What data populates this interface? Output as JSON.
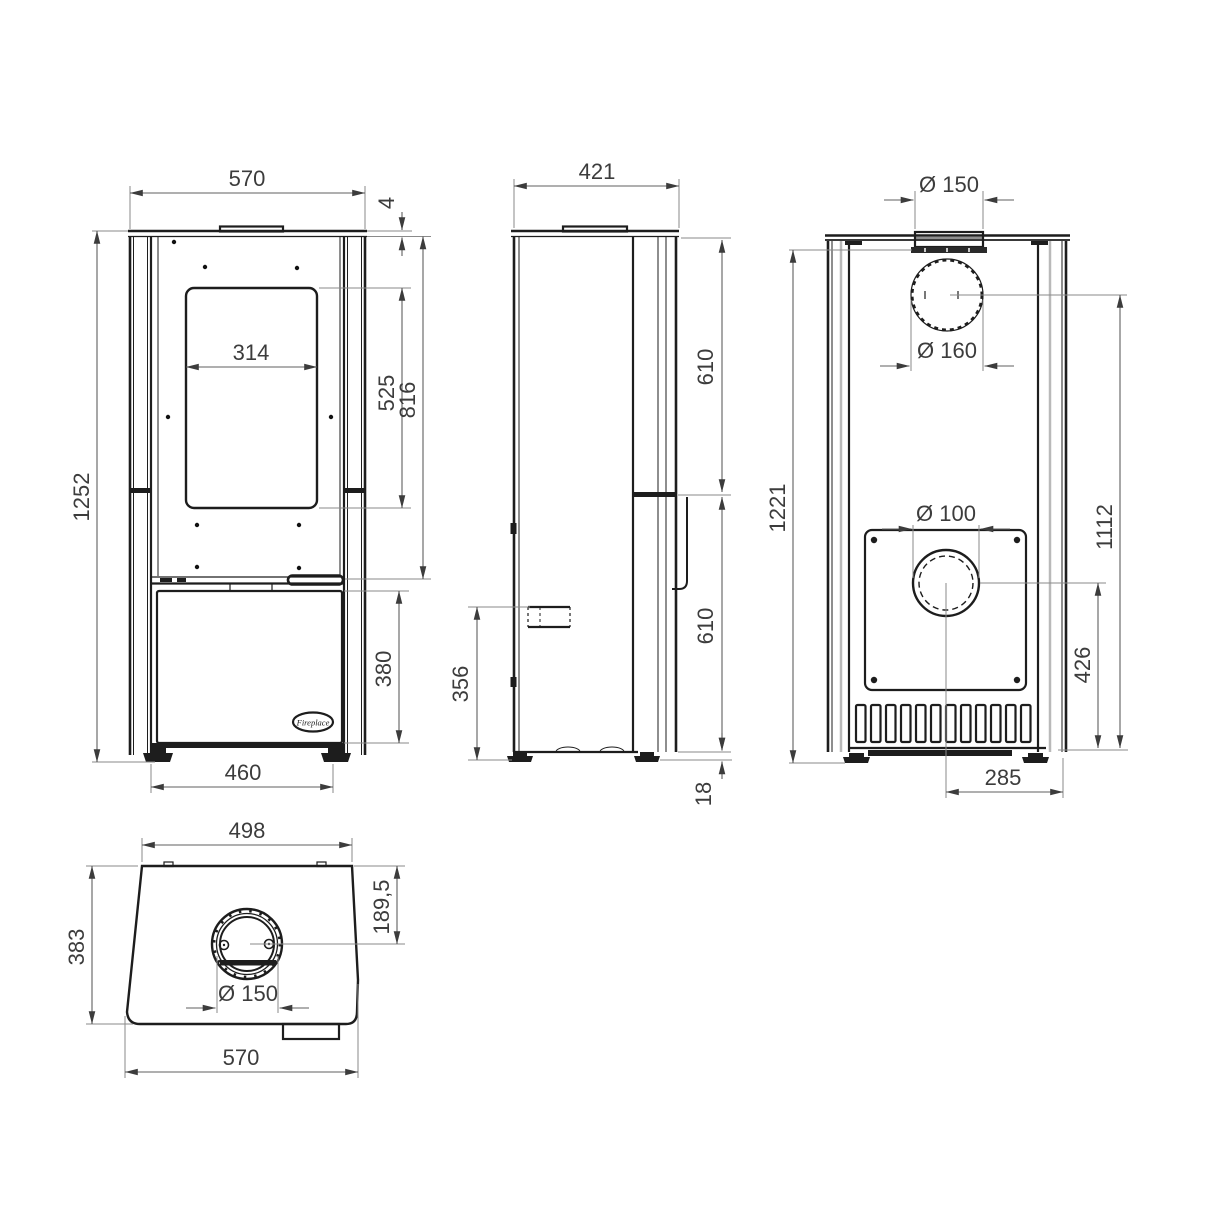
{
  "drawing": {
    "title": "Stove dimensional drawing",
    "line_color": "#1d1d1d",
    "dim_color": "#5f5f5f",
    "views": {
      "front": {
        "name": "front view",
        "logo_text": "Fireplace",
        "dims": {
          "overall_width": "570",
          "top_plate_thickness": "4",
          "glass_width": "314",
          "glass_height": "525",
          "top_to_shelf": "816",
          "overall_height": "1252",
          "door_height": "380",
          "feet_spacing": "460"
        }
      },
      "side": {
        "name": "side view",
        "dims": {
          "overall_depth": "421",
          "upper_section": "610",
          "lower_section": "610",
          "rear_connection_height": "356",
          "foot_height": "18"
        }
      },
      "rear": {
        "name": "rear view",
        "dims": {
          "collar_diameter": "Ø 150",
          "flue_diameter": "Ø 160",
          "air_inlet_diameter": "Ø 100",
          "body_height": "1221",
          "flue_center_height": "1112",
          "air_center_height": "426",
          "center_to_edge": "285"
        }
      },
      "top": {
        "name": "top view",
        "dims": {
          "rear_width": "498",
          "overall_depth": "383",
          "flue_center_offset": "189,5",
          "flue_diameter": "Ø 150",
          "front_width": "570"
        }
      }
    }
  }
}
